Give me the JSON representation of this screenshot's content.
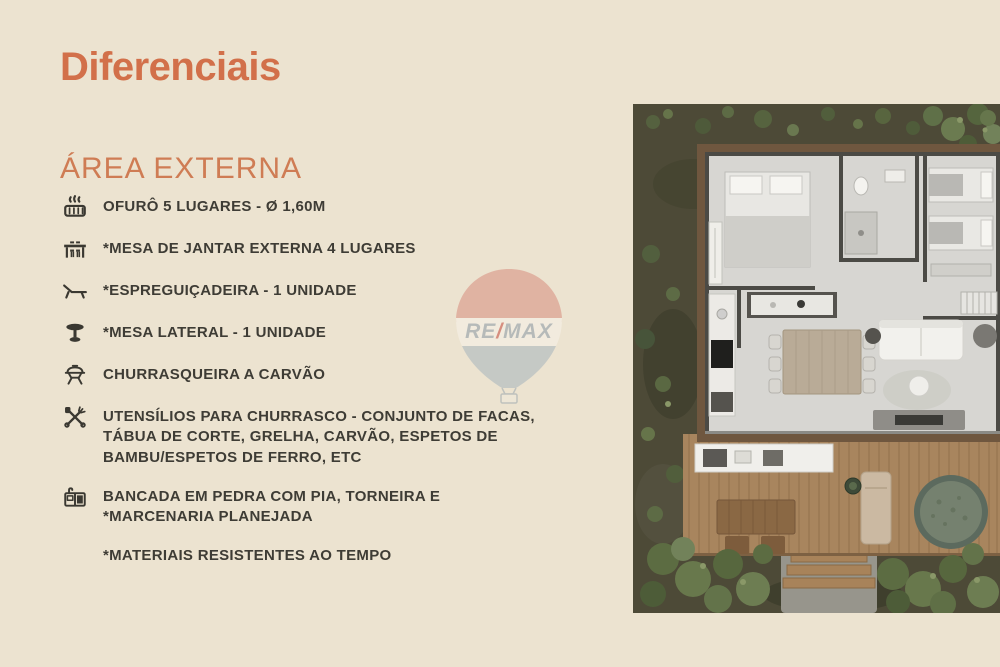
{
  "slide": {
    "title": "Diferenciais",
    "section": {
      "title": "ÁREA EXTERNA"
    },
    "features": [
      {
        "icon": "hot-tub-icon",
        "text": "OFURÔ 5 LUGARES - Ø 1,60M"
      },
      {
        "icon": "outdoor-dining-table-icon",
        "text": "*MESA DE JANTAR EXTERNA 4 LUGARES"
      },
      {
        "icon": "lounge-chair-icon",
        "text": "*ESPREGUIÇADEIRA - 1 UNIDADE"
      },
      {
        "icon": "side-table-icon",
        "text": "*MESA LATERAL - 1 UNIDADE"
      },
      {
        "icon": "charcoal-grill-icon",
        "text": "CHURRASQUEIRA A CARVÃO"
      },
      {
        "icon": "bbq-utensils-icon",
        "text": "UTENSÍLIOS PARA CHURRASCO - CONJUNTO DE FACAS, TÁBUA DE CORTE, GRELHA, CARVÃO, ESPETOS DE BAMBU/ESPETOS DE FERRO, ETC"
      },
      {
        "icon": "stone-counter-sink-icon",
        "text": "BANCADA EM PEDRA COM PIA, TORNEIRA E *MARCENARIA PLANEJADA"
      },
      {
        "icon": "",
        "text": "*MATERIAIS RESISTENTES AO TEMPO"
      }
    ]
  },
  "watermark": {
    "re": "RE",
    "slash": "/",
    "max": "MAX"
  },
  "floor_plan": {
    "label": "aerial floor plan render with deck, ofurô and garden"
  },
  "colors": {
    "background": "#ece3d0",
    "title": "#d2704a",
    "section_title": "#cf7c54",
    "text": "#3e3c35",
    "balloon_red": "#cd5145",
    "balloon_blue": "#9fb0bc",
    "deck_wood": "#a8855e",
    "interior_floor": "#d7d6d2",
    "wall": "#4b4a45",
    "vegetation": "#5c6c42"
  }
}
